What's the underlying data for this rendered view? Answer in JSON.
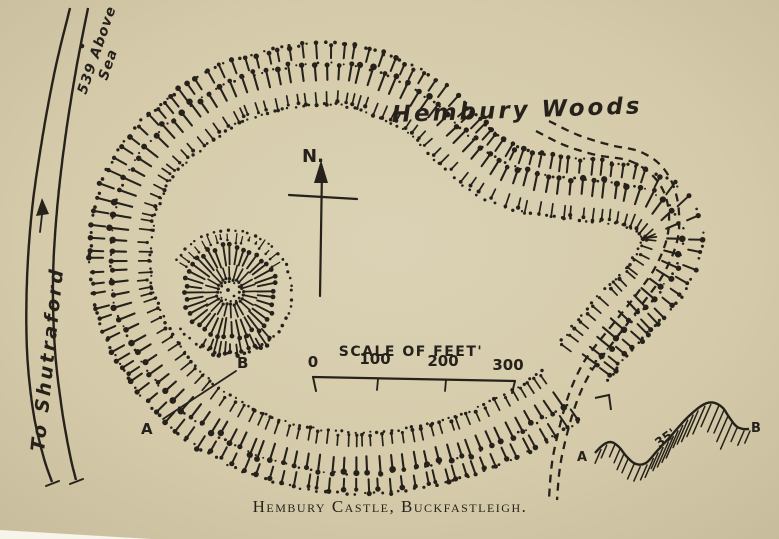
{
  "colors": {
    "paper": "#d5cbaa",
    "paper_light": "#dbd2b5",
    "paper_dark": "#c7bd9c",
    "ink": "#26211a",
    "page_edge": "#f7f4ea"
  },
  "labels": {
    "woods": "Hembury Woods",
    "north": "N.",
    "road": "To Shutraford",
    "elevation_1": "539 Above",
    "elevation_2": "Sea",
    "plan_a": "A",
    "plan_b": "B"
  },
  "scale_bar": {
    "title": "SCALE OF FEET'",
    "tick_0": "0",
    "tick_100": "100",
    "tick_200": "200",
    "tick_300": "300"
  },
  "profile": {
    "a": "A",
    "b": "B",
    "height": "35'"
  },
  "caption": "Hembury Castle, Buckfastleigh.",
  "icons": {
    "north_arrow": "north-arrow",
    "road_direction_arrow": "up-arrow"
  }
}
